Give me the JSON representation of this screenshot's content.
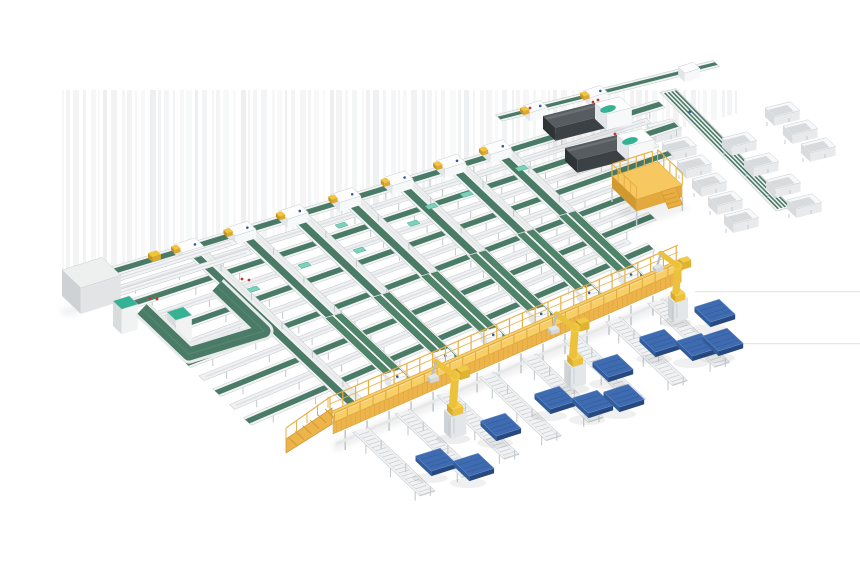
{
  "image": {
    "type": "3d-render",
    "subject": "automated-parcel-sortation-and-robotic-palletizing-system",
    "width": 860,
    "height": 580,
    "background": "#ffffff"
  },
  "colors": {
    "belt_green": "#4a7b67",
    "belt_green_dark": "#3d6854",
    "belt_green_bright": "#4e8468",
    "belt_green_edge": "#335a4a",
    "mint": "#35b194",
    "mint_light": "#7fd0b8",
    "frame_white": "#f3f4f5",
    "frame_stroke": "#c9cdd0",
    "frame_inner": "#eceeee",
    "roller_grey": "#d4d7da",
    "steel_grey": "#c5c9cb",
    "stringer_white": "#e6e8e9",
    "gantry_deck": "#f8ce66",
    "gantry_deck_hi": "#fce09a",
    "gantry_fascia": "#eeb44c",
    "gantry_dark": "#d1992f",
    "gantry_rail": "#e8b148",
    "gantry_edge": "#dca63c",
    "platform_top": "#f6c85f",
    "platform_front": "#e3a93f",
    "platform_side": "#d1992f",
    "robot_yellow": "#ecc23c",
    "robot_yellow_dark": "#c89a28",
    "robot_grey": "#d5d8da",
    "pallet_top": "#3f6cb0",
    "pallet_front": "#27497f",
    "pallet_side": "#335c9b",
    "pallet_rim": "#6f95cf",
    "pallet_slat": "#2e549a",
    "machine_body": "#3b4145",
    "machine_top": "#565c60",
    "machine_side": "#2e3336",
    "head_white": "#f7f8f9",
    "head_side": "#e3e6e8",
    "head_top": "#fdfdfd",
    "cab_top": "#eef0f0",
    "cab_front": "#e2e4e5",
    "cab_side": "#cfd2d4",
    "bin_top": "#f7f8f9",
    "bin_inner": "#d7dbdd",
    "bin_front": "#e8eaec",
    "bin_side": "#d9dcdf",
    "accent_red": "#c0392b",
    "accent_blue": "#2e59a6",
    "accent_yellow": "#f2c33c",
    "streak_a": "#e7e8ea",
    "streak_b": "#dfe1e3",
    "floor_line": "#dcdddd",
    "shadow": "#000000"
  },
  "layout": {
    "vec": {
      "u0": [
        0.953,
        -0.304
      ],
      "v": [
        0.725,
        0.688
      ],
      "uf": [
        0.97,
        -0.243
      ],
      "g": [
        0.916,
        -0.4
      ],
      "vb": [
        0.7,
        0.714
      ],
      "vp": [
        1759,
        -232
      ],
      "uw": [
        0.95,
        -0.3
      ]
    },
    "streaks": {
      "x0": 62,
      "x1": 737,
      "y_top": 90,
      "base": 292,
      "slope": 0.2655,
      "max_opacity": 0.55
    },
    "floor_lines": [
      [
        695,
        291,
        860
      ],
      [
        668,
        343,
        860
      ]
    ],
    "grid": {
      "origin": [
        95,
        277
      ],
      "green_offsets": [
        0,
        42,
        84,
        126,
        168,
        210
      ],
      "green_lengths": [
        592,
        580,
        545,
        500,
        470,
        440
      ],
      "white_offsets": [
        21,
        63,
        105,
        147,
        189
      ],
      "white_lengths": [
        565,
        545,
        505,
        465,
        430
      ],
      "vlane_t": [
        100,
        155,
        210,
        265,
        320,
        375,
        423
      ],
      "vlane_width": 19,
      "decline_len": 95
    },
    "uloop": [
      [
        142,
        309
      ],
      [
        189,
        354
      ],
      [
        264,
        331
      ],
      [
        217,
        286
      ]
    ],
    "cabinet": {
      "base": [
        62,
        270
      ],
      "w": 42,
      "d": 26,
      "h": 26
    },
    "teal_boxes": [
      [
        113,
        301
      ],
      [
        167,
        312
      ]
    ],
    "feed_lines": [
      {
        "b": [
          100,
          284
        ],
        "len": 142
      },
      {
        "b": [
          106,
          297
        ],
        "len": 152
      }
    ],
    "yellow_item": [
      152,
      256
    ],
    "red_dots": [
      [
        150,
        298
      ],
      [
        157,
        299
      ],
      [
        242,
        279
      ],
      [
        249,
        280
      ],
      [
        530,
        108
      ],
      [
        598,
        100
      ],
      [
        575,
        133
      ]
    ],
    "machines": [
      {
        "body": [
          543,
          116
        ],
        "head": [
          595,
          103
        ]
      },
      {
        "body": [
          565,
          148
        ],
        "head": [
          617,
          135
        ]
      }
    ],
    "topline": {
      "b": [
        499,
        118
      ],
      "len": 166,
      "stations": [
        30,
        92
      ]
    },
    "stub_len": 58,
    "branch": {
      "b": [
        662,
        92
      ],
      "len": 166,
      "stripes": 4
    },
    "bins": {
      "left": [
        [
          660,
          130
        ],
        [
          675,
          148
        ],
        [
          690,
          166
        ],
        [
          705,
          184
        ],
        [
          721,
          202
        ],
        [
          737,
          220
        ]
      ],
      "right": [
        [
          735,
          143
        ],
        [
          757,
          164
        ],
        [
          779,
          185
        ],
        [
          800,
          205
        ]
      ],
      "far": [
        [
          778,
          113
        ],
        [
          796,
          131
        ],
        [
          814,
          149
        ]
      ]
    },
    "platform": {
      "base": [
        612,
        176
      ],
      "w": 48,
      "d": 34,
      "h": 12,
      "rail": 12
    },
    "gantry": {
      "p0": [
        330,
        412
      ],
      "len": 380,
      "deck_off": [
        4.5,
        10
      ],
      "fascia_h": 13,
      "leg_len": 20,
      "rail_h": 15,
      "front_rail_h": 9
    },
    "ramp": {
      "run": -44,
      "drop": 31,
      "thick": 14,
      "steps": 6
    },
    "spurs": {
      "s": [
        14,
        60,
        106,
        152,
        198,
        244,
        290,
        336
      ],
      "len": 92,
      "w": 16
    },
    "robots": [
      {
        "b": [
          453,
          436
        ],
        "s": 1.0
      },
      {
        "b": [
          573,
          386
        ],
        "s": 0.97
      },
      {
        "b": [
          676,
          320
        ],
        "s": 0.9
      }
    ],
    "pallets": [
      [
        428,
        469
      ],
      [
        466,
        474
      ],
      [
        493,
        434
      ],
      [
        547,
        407
      ],
      [
        585,
        411
      ],
      [
        616,
        405
      ],
      [
        605,
        375
      ],
      [
        652,
        350
      ],
      [
        689,
        354
      ],
      [
        715,
        349
      ],
      [
        707,
        320
      ]
    ],
    "mint_chips": [
      [
        303,
        267
      ],
      [
        340,
        227
      ],
      [
        358,
        252
      ],
      [
        412,
        225
      ],
      [
        465,
        196
      ],
      [
        252,
        291
      ],
      [
        520,
        170
      ],
      [
        430,
        208
      ]
    ]
  }
}
